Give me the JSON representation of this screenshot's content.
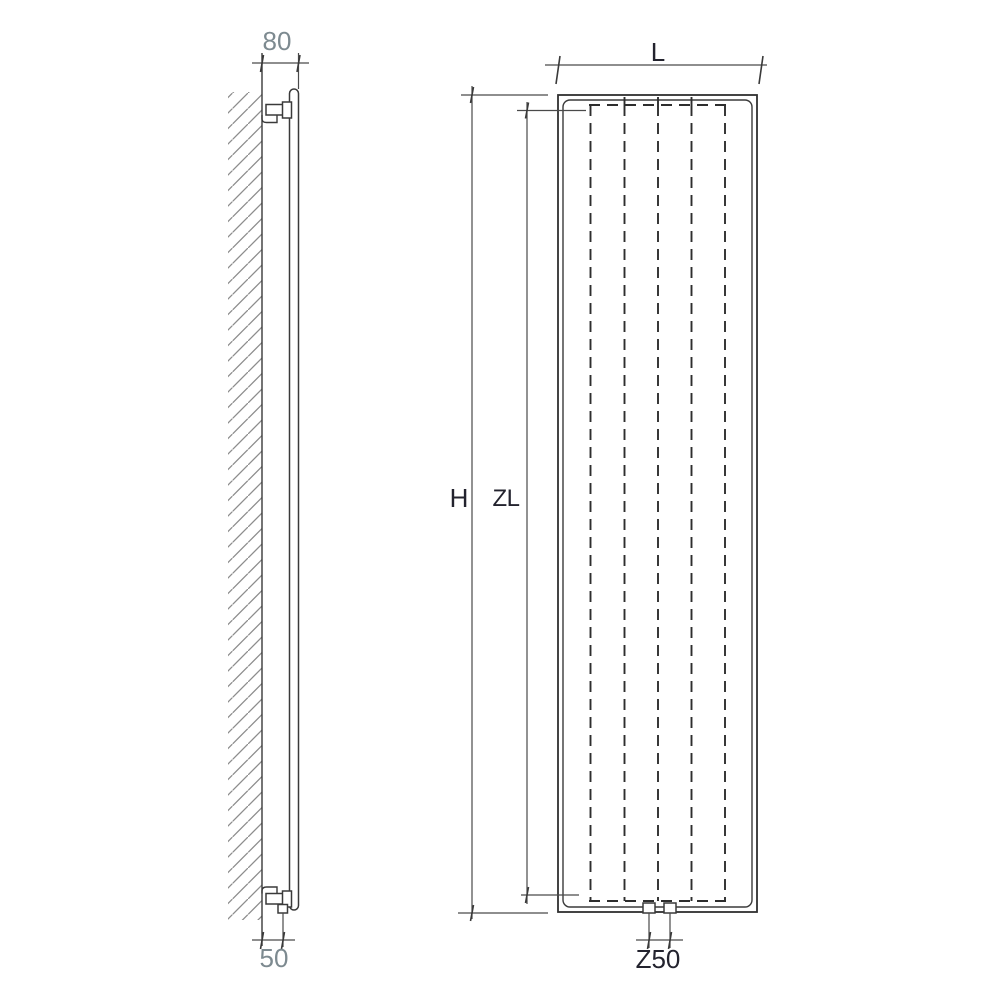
{
  "figure": {
    "title": "radiator-dimension-diagram",
    "views": {
      "side_view": "wall-mounted radiator side profile with mounting brackets",
      "front_view": "radiator front elevation with convector fin dashed lines"
    },
    "labels": {
      "side_depth_top": "80",
      "side_offset_bottom": "50",
      "front_width": "L",
      "front_height": "H",
      "front_inner_height": "ZL",
      "front_connection_spacing": "Z50"
    },
    "colors": {
      "background": "#ffffff",
      "line": "#3a3a3a",
      "dashed_line": "#2e2e2e",
      "hatch": "#8c8c8c",
      "dim_text_gray": "#7d8a90",
      "dim_text_dark": "#23232e"
    }
  }
}
